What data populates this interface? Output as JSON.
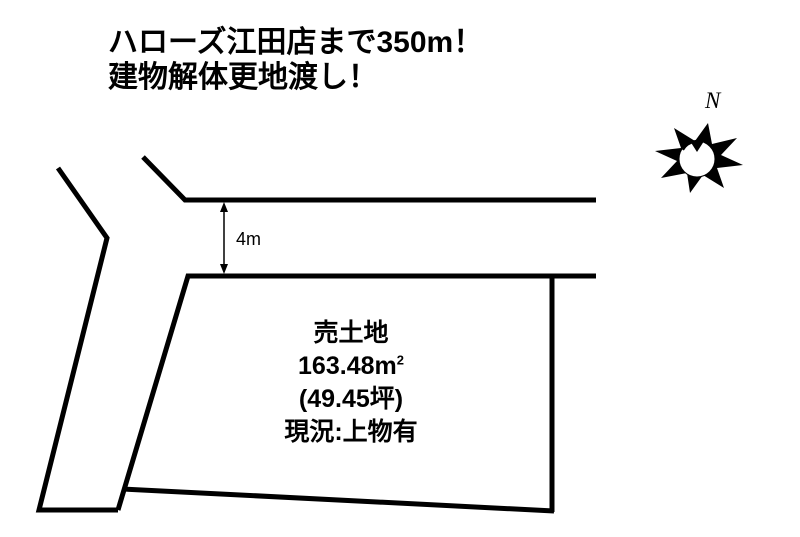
{
  "headline": {
    "line1": "ハローズ江田店まで350m！",
    "line2": "建物解体更地渡し！"
  },
  "compass": {
    "north_label": "N"
  },
  "dimension": {
    "road_width_label": "4m"
  },
  "plot": {
    "title": "売土地",
    "area_value": "163.48",
    "area_unit": "m",
    "area_exponent": "2",
    "area_tsubo": "(49.45坪)",
    "status": "現況:上物有"
  },
  "colors": {
    "line": "#000000",
    "background": "#ffffff"
  }
}
